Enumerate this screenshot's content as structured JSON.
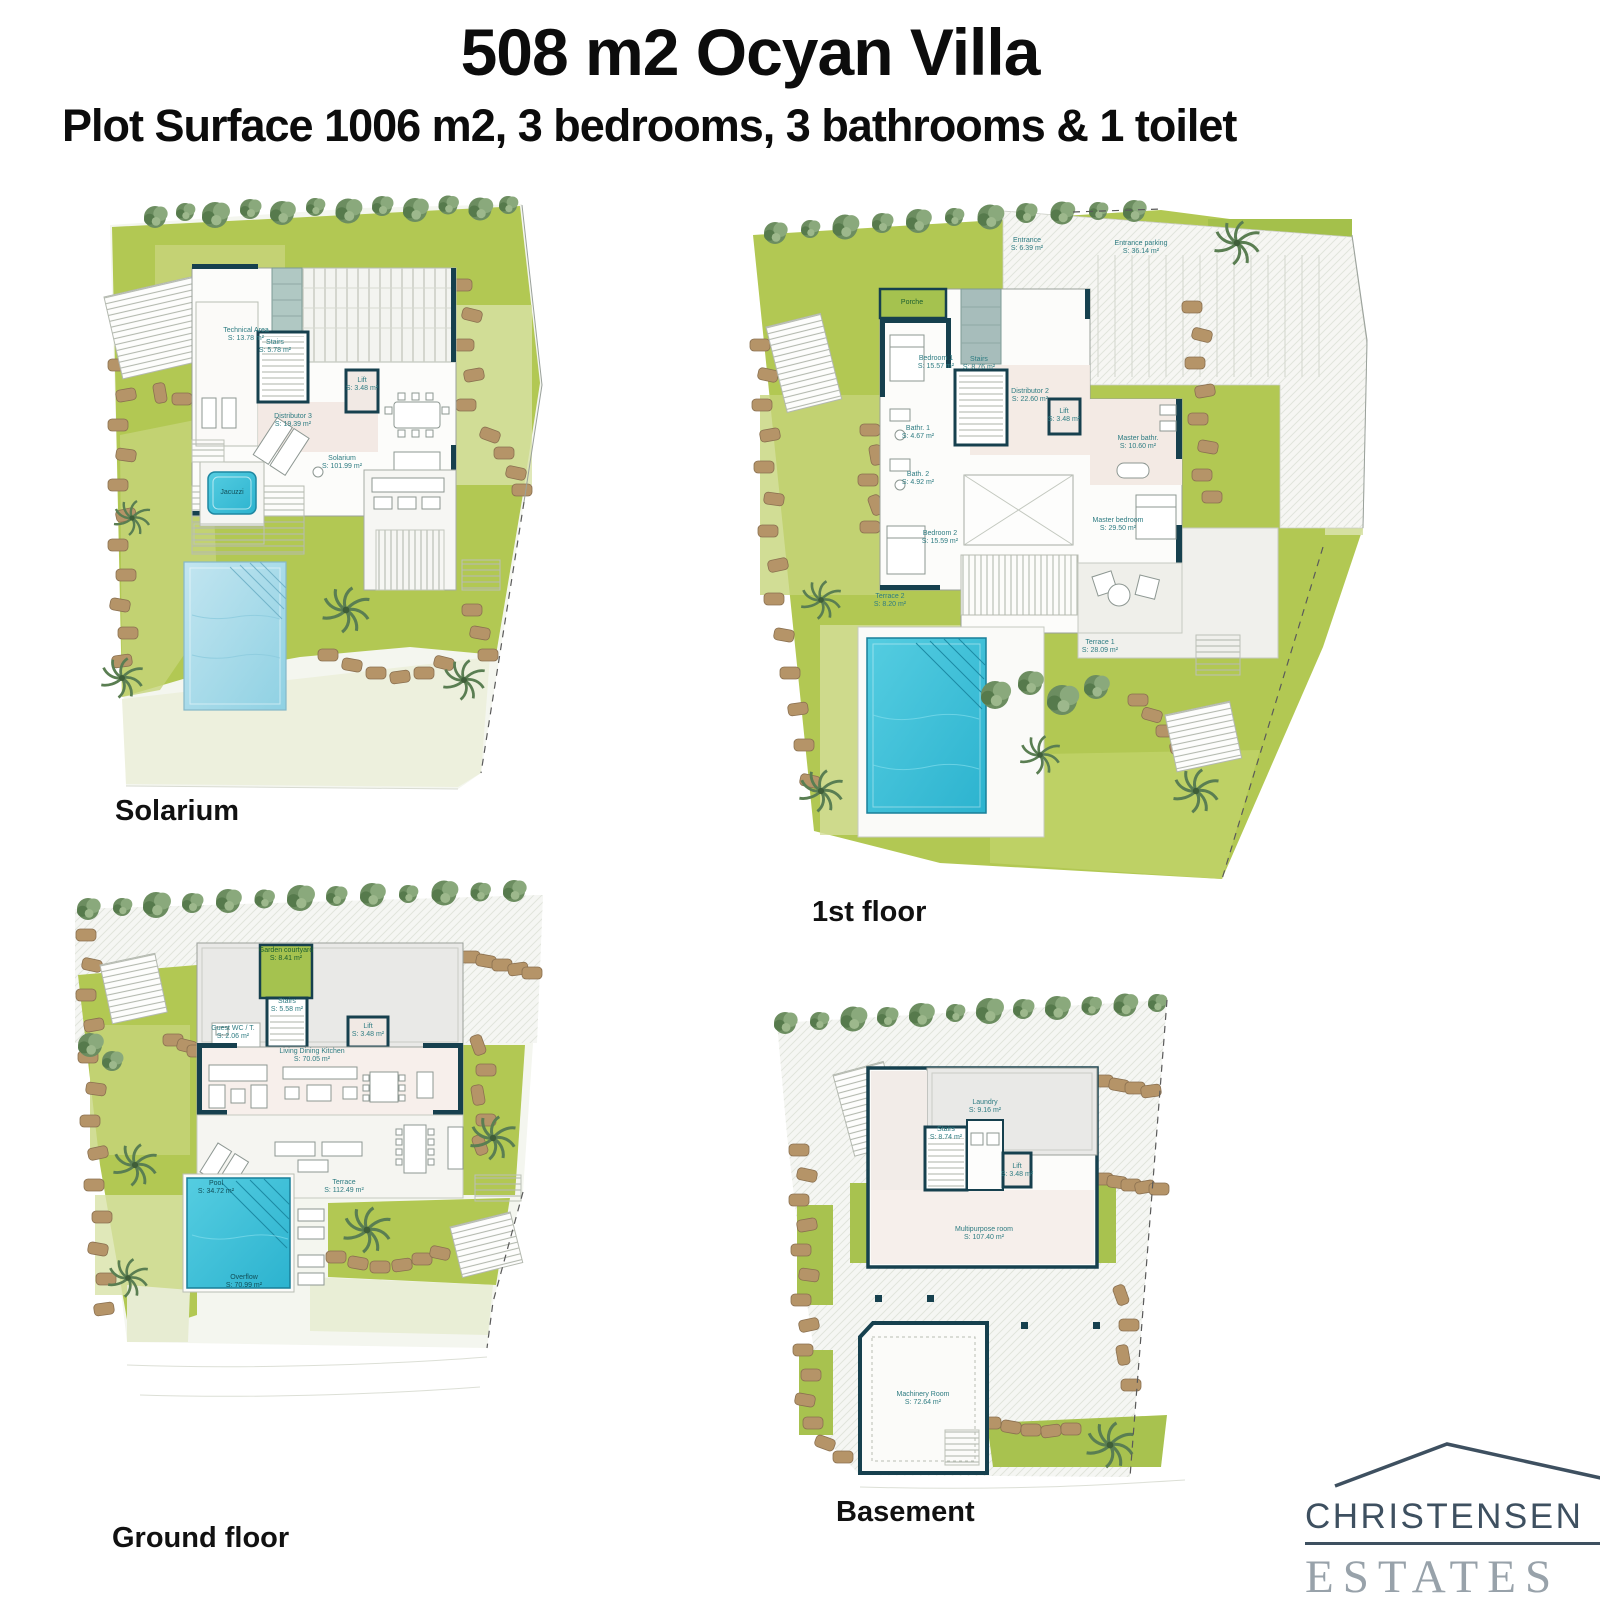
{
  "page": {
    "title": "508 m2 Ocyan Villa",
    "subtitle": "Plot Surface 1006 m2, 3 bedrooms, 3 bathrooms & 1 toilet"
  },
  "logo": {
    "line1": "CHRISTENSEN",
    "line2": "ESTATES"
  },
  "colors": {
    "wall": "#16404e",
    "label_teal": "#2e7c82",
    "grass": "#b2c853",
    "grass_light": "#cbd88c",
    "pool_bright": "#3fc3dc",
    "pool_light": "#a9d8e7",
    "stone": "#ab8c60",
    "concrete": "#e9e9e6",
    "logo_dark": "#3e5060",
    "logo_gray": "#98a2aa"
  },
  "plans": {
    "solarium": {
      "caption": "Solarium",
      "rooms": [
        {
          "name": "Technical Area",
          "area": "S: 13.78 m²"
        },
        {
          "name": "Stairs",
          "area": "S: 5.78 m²"
        },
        {
          "name": "Lift",
          "area": "S: 3.48 m²"
        },
        {
          "name": "Distributor 3",
          "area": "S: 19.39 m²"
        },
        {
          "name": "Solarium",
          "area": "S: 101.99 m²"
        },
        {
          "name": "Jacuzzi",
          "area": ""
        }
      ]
    },
    "first_floor": {
      "caption": "1st floor",
      "rooms": [
        {
          "name": "Porche",
          "area": ""
        },
        {
          "name": "Entrance",
          "area": "S: 6.39 m²"
        },
        {
          "name": "Entrance parking",
          "area": "S: 36.14 m²"
        },
        {
          "name": "Bedroom 1",
          "area": "S: 15.57 m²"
        },
        {
          "name": "Stairs",
          "area": "S: 8.76 m²"
        },
        {
          "name": "Distributor 2",
          "area": "S: 22.60 m²"
        },
        {
          "name": "Lift",
          "area": "S: 3.48 m²"
        },
        {
          "name": "Bathr. 1",
          "area": "S: 4.67 m²"
        },
        {
          "name": "Bath. 2",
          "area": "S: 4.92 m²"
        },
        {
          "name": "Master bathr.",
          "area": "S: 10.60 m²"
        },
        {
          "name": "Master bedroom",
          "area": "S: 29.50 m²"
        },
        {
          "name": "Bedroom 2",
          "area": "S: 15.59 m²"
        },
        {
          "name": "Terrace 2",
          "area": "S: 8.20 m²"
        },
        {
          "name": "Terrace 1",
          "area": "S: 28.09 m²"
        }
      ]
    },
    "ground_floor": {
      "caption": "Ground floor",
      "rooms": [
        {
          "name": "Garden courtyard",
          "area": "S: 8.41 m²"
        },
        {
          "name": "Stairs",
          "area": "S: 5.58 m²"
        },
        {
          "name": "Guest WC / T.",
          "area": "S: 2.06 m²"
        },
        {
          "name": "Lift",
          "area": "S: 3.48 m²"
        },
        {
          "name": "Living Dining Kitchen",
          "area": "S: 70.05 m²"
        },
        {
          "name": "Terrace",
          "area": "S: 112.49 m²"
        },
        {
          "name": "Pool",
          "area": "S: 34.72 m²"
        },
        {
          "name": "Overflow",
          "area": "S: 70.99 m²"
        }
      ]
    },
    "basement": {
      "caption": "Basement",
      "rooms": [
        {
          "name": "Stairs",
          "area": "S: 8.74 m²"
        },
        {
          "name": "Laundry",
          "area": "S: 9.16 m²"
        },
        {
          "name": "Lift",
          "area": "S: 3.48 m²"
        },
        {
          "name": "Multipurpose room",
          "area": "S: 107.40 m²"
        },
        {
          "name": "Machinery Room",
          "area": "S: 72.64 m²"
        }
      ]
    }
  }
}
